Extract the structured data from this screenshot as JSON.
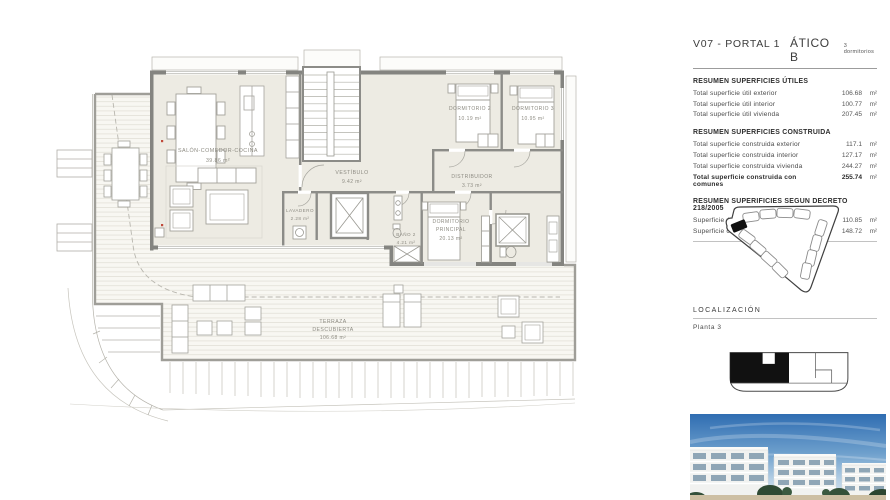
{
  "header": {
    "portal": "V07 - PORTAL 1",
    "unit": "ÁTICO B",
    "bedrooms": "3 dormitorios"
  },
  "utiles": {
    "heading": "RESUMEN SUPERFICIES ÚTILES",
    "rows": [
      {
        "label": "Total superficie útil exterior",
        "value": "106.68",
        "unit": "m²"
      },
      {
        "label": "Total superficie útil interior",
        "value": "100.77",
        "unit": "m²"
      },
      {
        "label": "Total superficie útil vivienda",
        "value": "207.45",
        "unit": "m²"
      }
    ]
  },
  "construida": {
    "heading": "RESUMEN SUPERFICIES CONSTRUIDA",
    "rows": [
      {
        "label": "Total superficie construida exterior",
        "value": "117.1",
        "unit": "m²"
      },
      {
        "label": "Total superficie construida interior",
        "value": "127.17",
        "unit": "m²"
      },
      {
        "label": "Total superficie construida vivienda",
        "value": "244.27",
        "unit": "m²"
      },
      {
        "label": "Total superficie construida con comunes",
        "value": "255.74",
        "unit": "m²"
      }
    ]
  },
  "decreto": {
    "heading": "RESUMEN SUPERIFICIES SEGUN DECRETO 218/2005",
    "rows": [
      {
        "label": "Superficie útil BOJA",
        "value": "110.85",
        "unit": "m²"
      },
      {
        "label": "Superficie construida BOJA",
        "value": "148.72",
        "unit": "m²"
      }
    ]
  },
  "localizacion": {
    "heading": "LOCALIZACIÓN",
    "floor": "Planta  3"
  },
  "plan": {
    "salon": {
      "line1": "SALÓN-COMEDOR-COCINA",
      "area": "39.86 m²"
    },
    "vestibulo": {
      "line1": "VESTÍBULO",
      "area": "9.42 m²"
    },
    "lavadero": {
      "line1": "LAVADERO",
      "area": "2.28 m²"
    },
    "dormitorio2": {
      "line1": "DORMITORIO 2",
      "area": "10.19 m²"
    },
    "dormitorio3": {
      "line1": "DORMITORIO 3",
      "area": "10.95 m²"
    },
    "distribuidor": {
      "line1": "DISTRIBUIDOR",
      "area": "3.73 m²"
    },
    "bano2": {
      "line1": "BAÑO 2",
      "area": "4.21 m²"
    },
    "principal": {
      "line1": "DORMITORIO",
      "line2": "PRINCIPAL",
      "area": "20.13 m²"
    },
    "terraza": {
      "line1": "TERRAZA",
      "line2": "DESCUBIERTA",
      "area": "106.68 m²"
    }
  }
}
